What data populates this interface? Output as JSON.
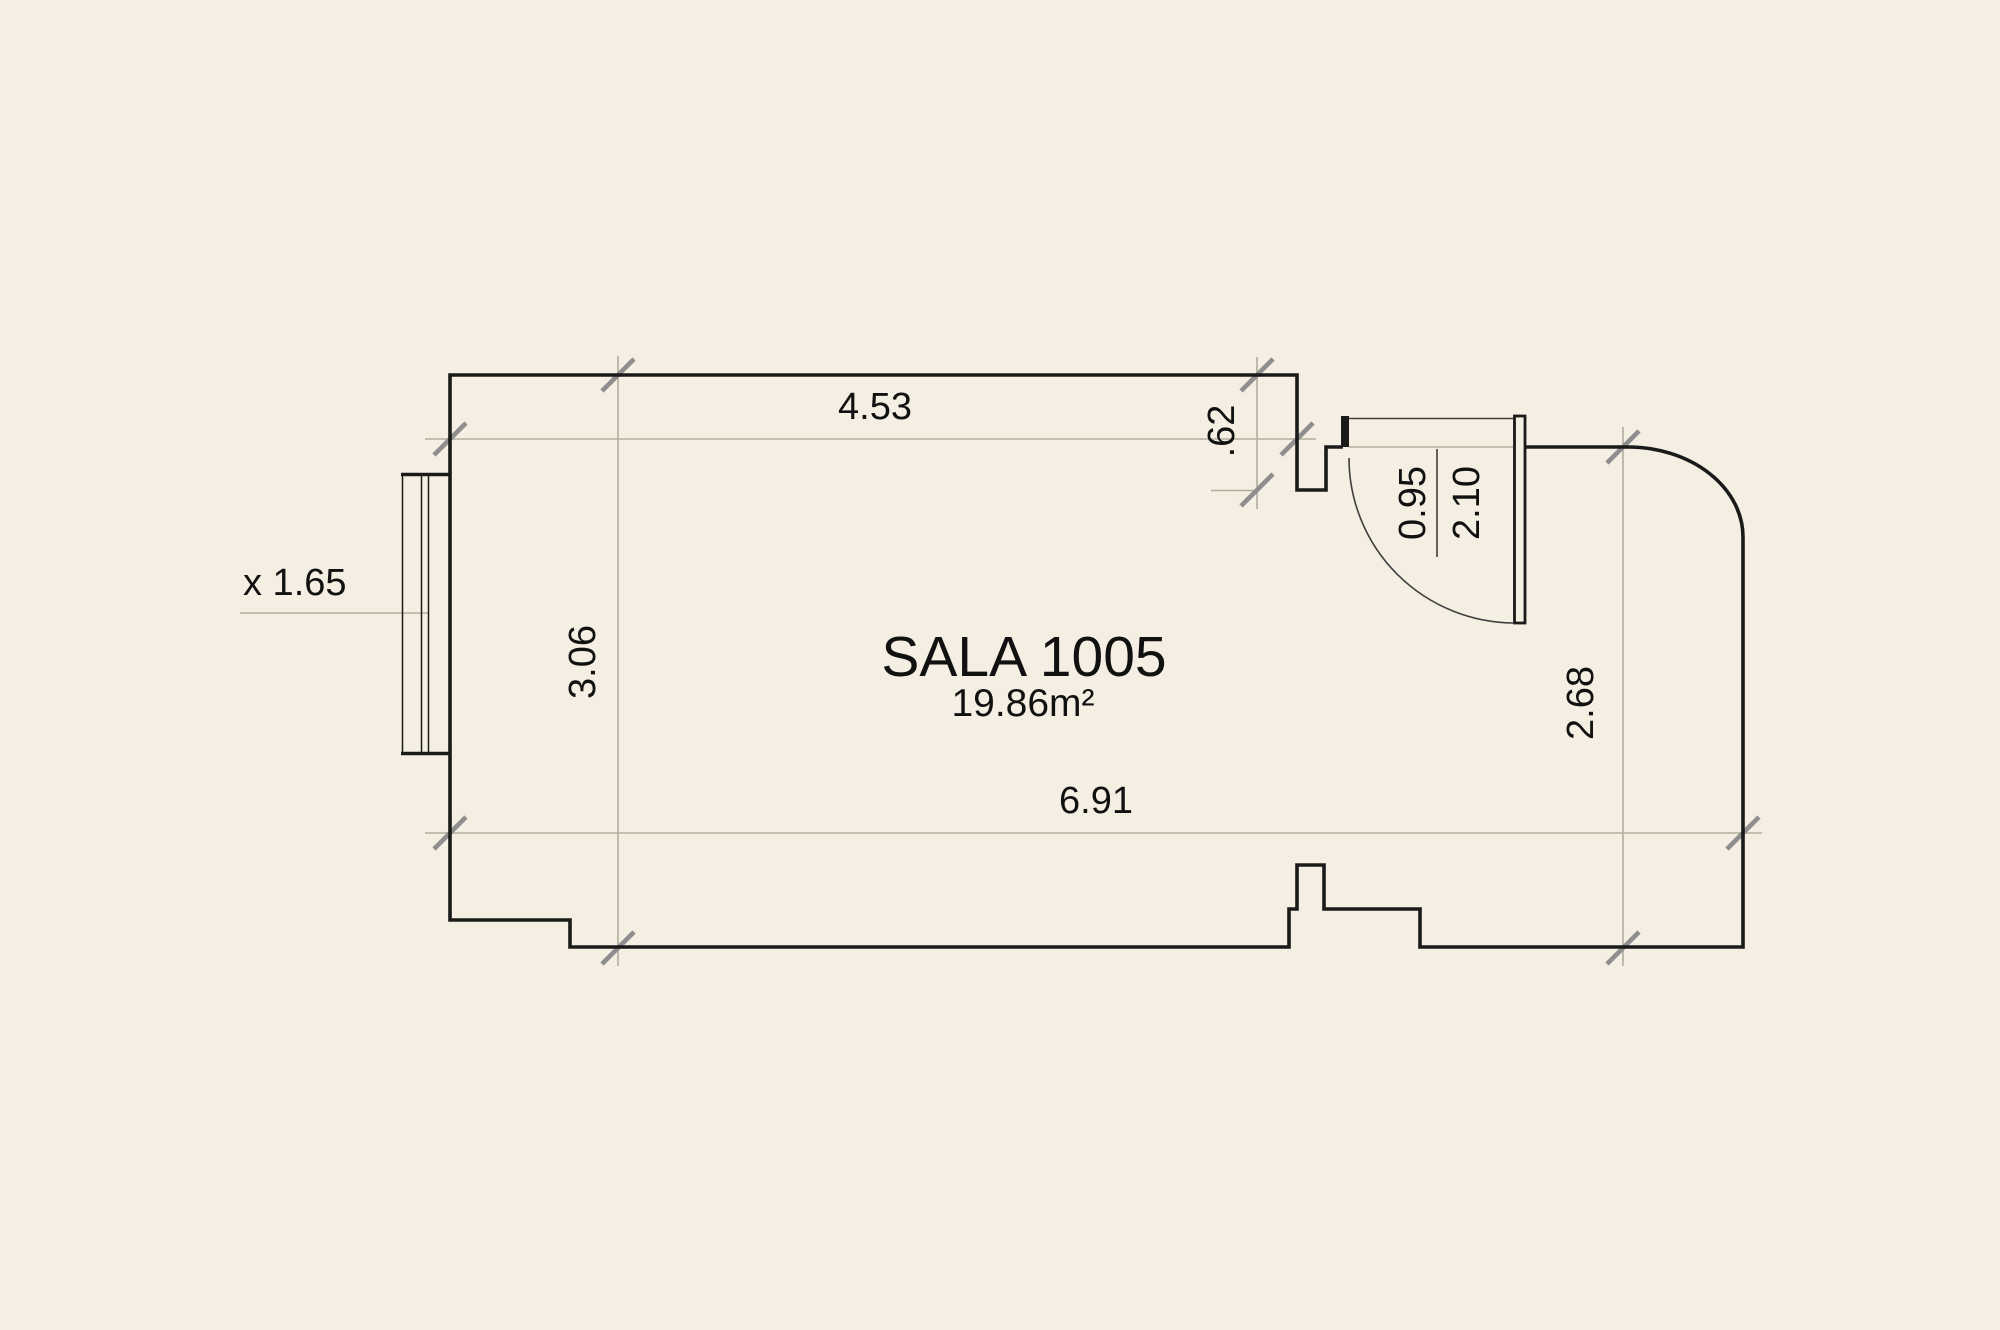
{
  "drawing": {
    "room_name": "SALA 1005",
    "room_area": "19.86m²",
    "dims": {
      "top_width": "4.53",
      "top_step": ".62",
      "door_width": "0.95",
      "door_height": "2.10",
      "window_label": "x 1.65",
      "left_height": "3.06",
      "bottom_width": "6.91",
      "right_height": "2.68"
    },
    "colors": {
      "background": "#f4efe2",
      "wall": "#1a1a1a",
      "dimension_line": "#b3ad9e",
      "tick": "#8e8e8e",
      "text": "#111111"
    }
  }
}
